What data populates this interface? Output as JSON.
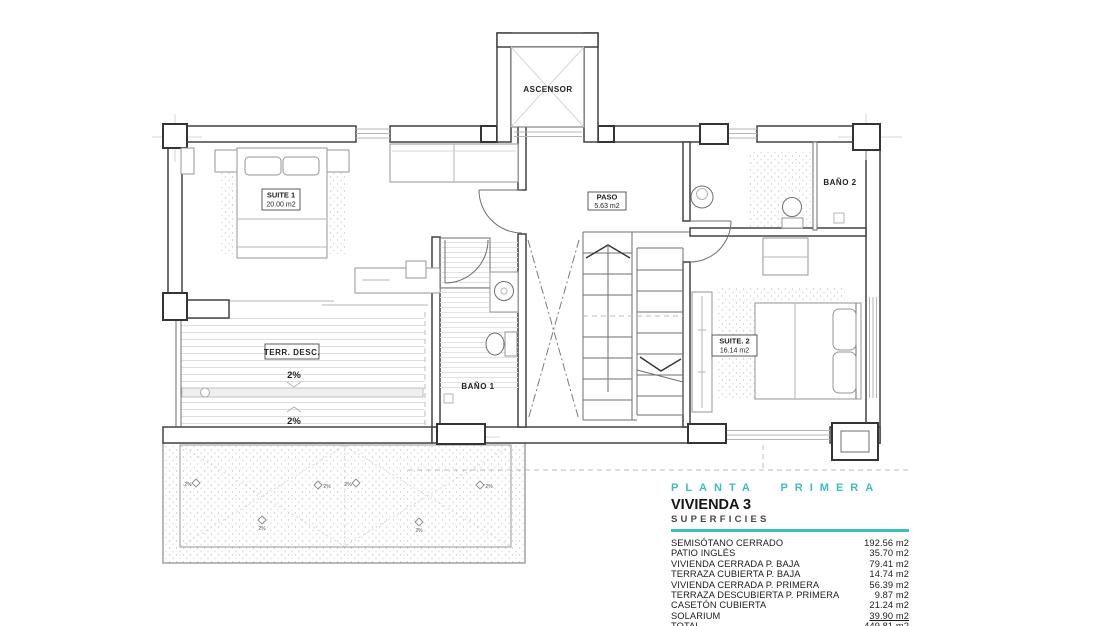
{
  "plan": {
    "labels": {
      "ascensor": "ASCENSOR",
      "suite1_name": "SUITE 1",
      "suite1_area": "20.00 m2",
      "paso_name": "PASO",
      "paso_area": "5.63 m2",
      "bano1": "BAÑO 1",
      "bano2": "BAÑO 2",
      "suite2_name": "SUITE. 2",
      "suite2_area": "16.14 m2",
      "terraza": "TERR. DESC.",
      "slope": "2%"
    }
  },
  "legend": {
    "floor_title": "PLANTA PRIMERA",
    "unit_title": "VIVIENDA 3",
    "section_title": "SUPERFICIES",
    "accent_color": "#3DBEBE",
    "rows": [
      {
        "label": "SEMISÓTANO CERRADO",
        "value": "192.56 m2"
      },
      {
        "label": "PATIO INGLÉS",
        "value": "35.70 m2"
      },
      {
        "label": "VIVIENDA CERRADA P. BAJA",
        "value": "79.41 m2"
      },
      {
        "label": "TERRAZA CUBIERTA P. BAJA",
        "value": "14.74 m2"
      },
      {
        "label": "VIVIENDA CERRADA P. PRIMERA",
        "value": "56.39 m2"
      },
      {
        "label": "TERRAZA DESCUBIERTA P. PRIMERA",
        "value": "9.87 m2"
      },
      {
        "label": "CASETÓN CUBIERTA",
        "value": "21.24 m2"
      },
      {
        "label": "SOLARIUM",
        "value": "39.90 m2"
      },
      {
        "label": "TOTAL",
        "value": "449.81 m2"
      }
    ]
  }
}
